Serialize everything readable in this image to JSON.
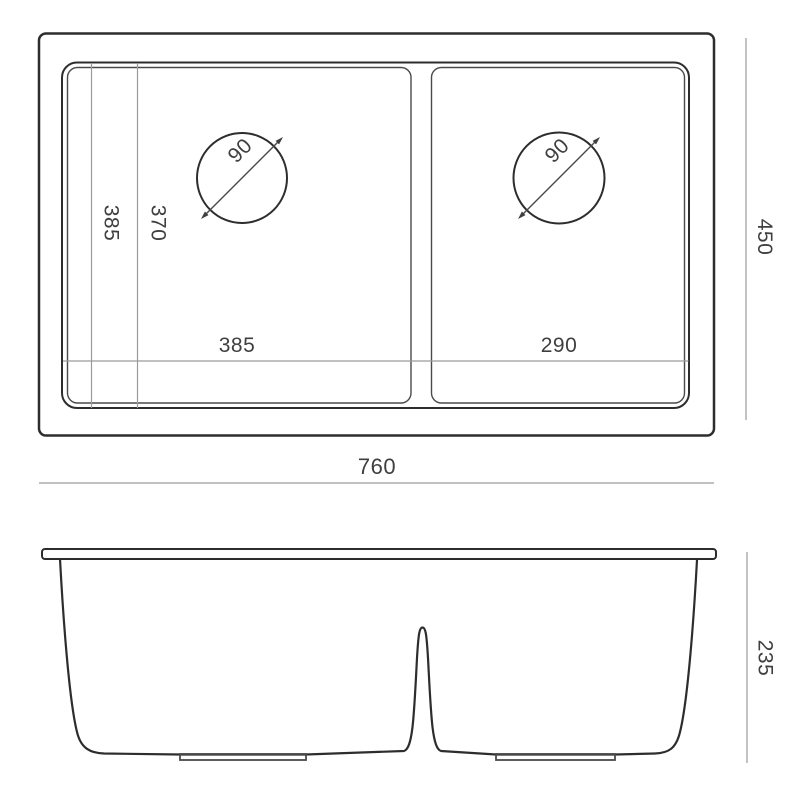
{
  "drawing": {
    "top_view": {
      "overall_width": "760",
      "overall_depth": "450",
      "left_bowl_width": "385",
      "right_bowl_width": "290",
      "left_bowl_length": "385",
      "left_bowl_inner_length": "370",
      "left_drain_diameter": "90",
      "right_drain_diameter": "90"
    },
    "front_view": {
      "overall_height": "235"
    },
    "colors": {
      "outline": "#2d2d2d",
      "dimension_line": "#9b9b9b",
      "text": "#3f3f3f",
      "background": "#ffffff"
    }
  }
}
